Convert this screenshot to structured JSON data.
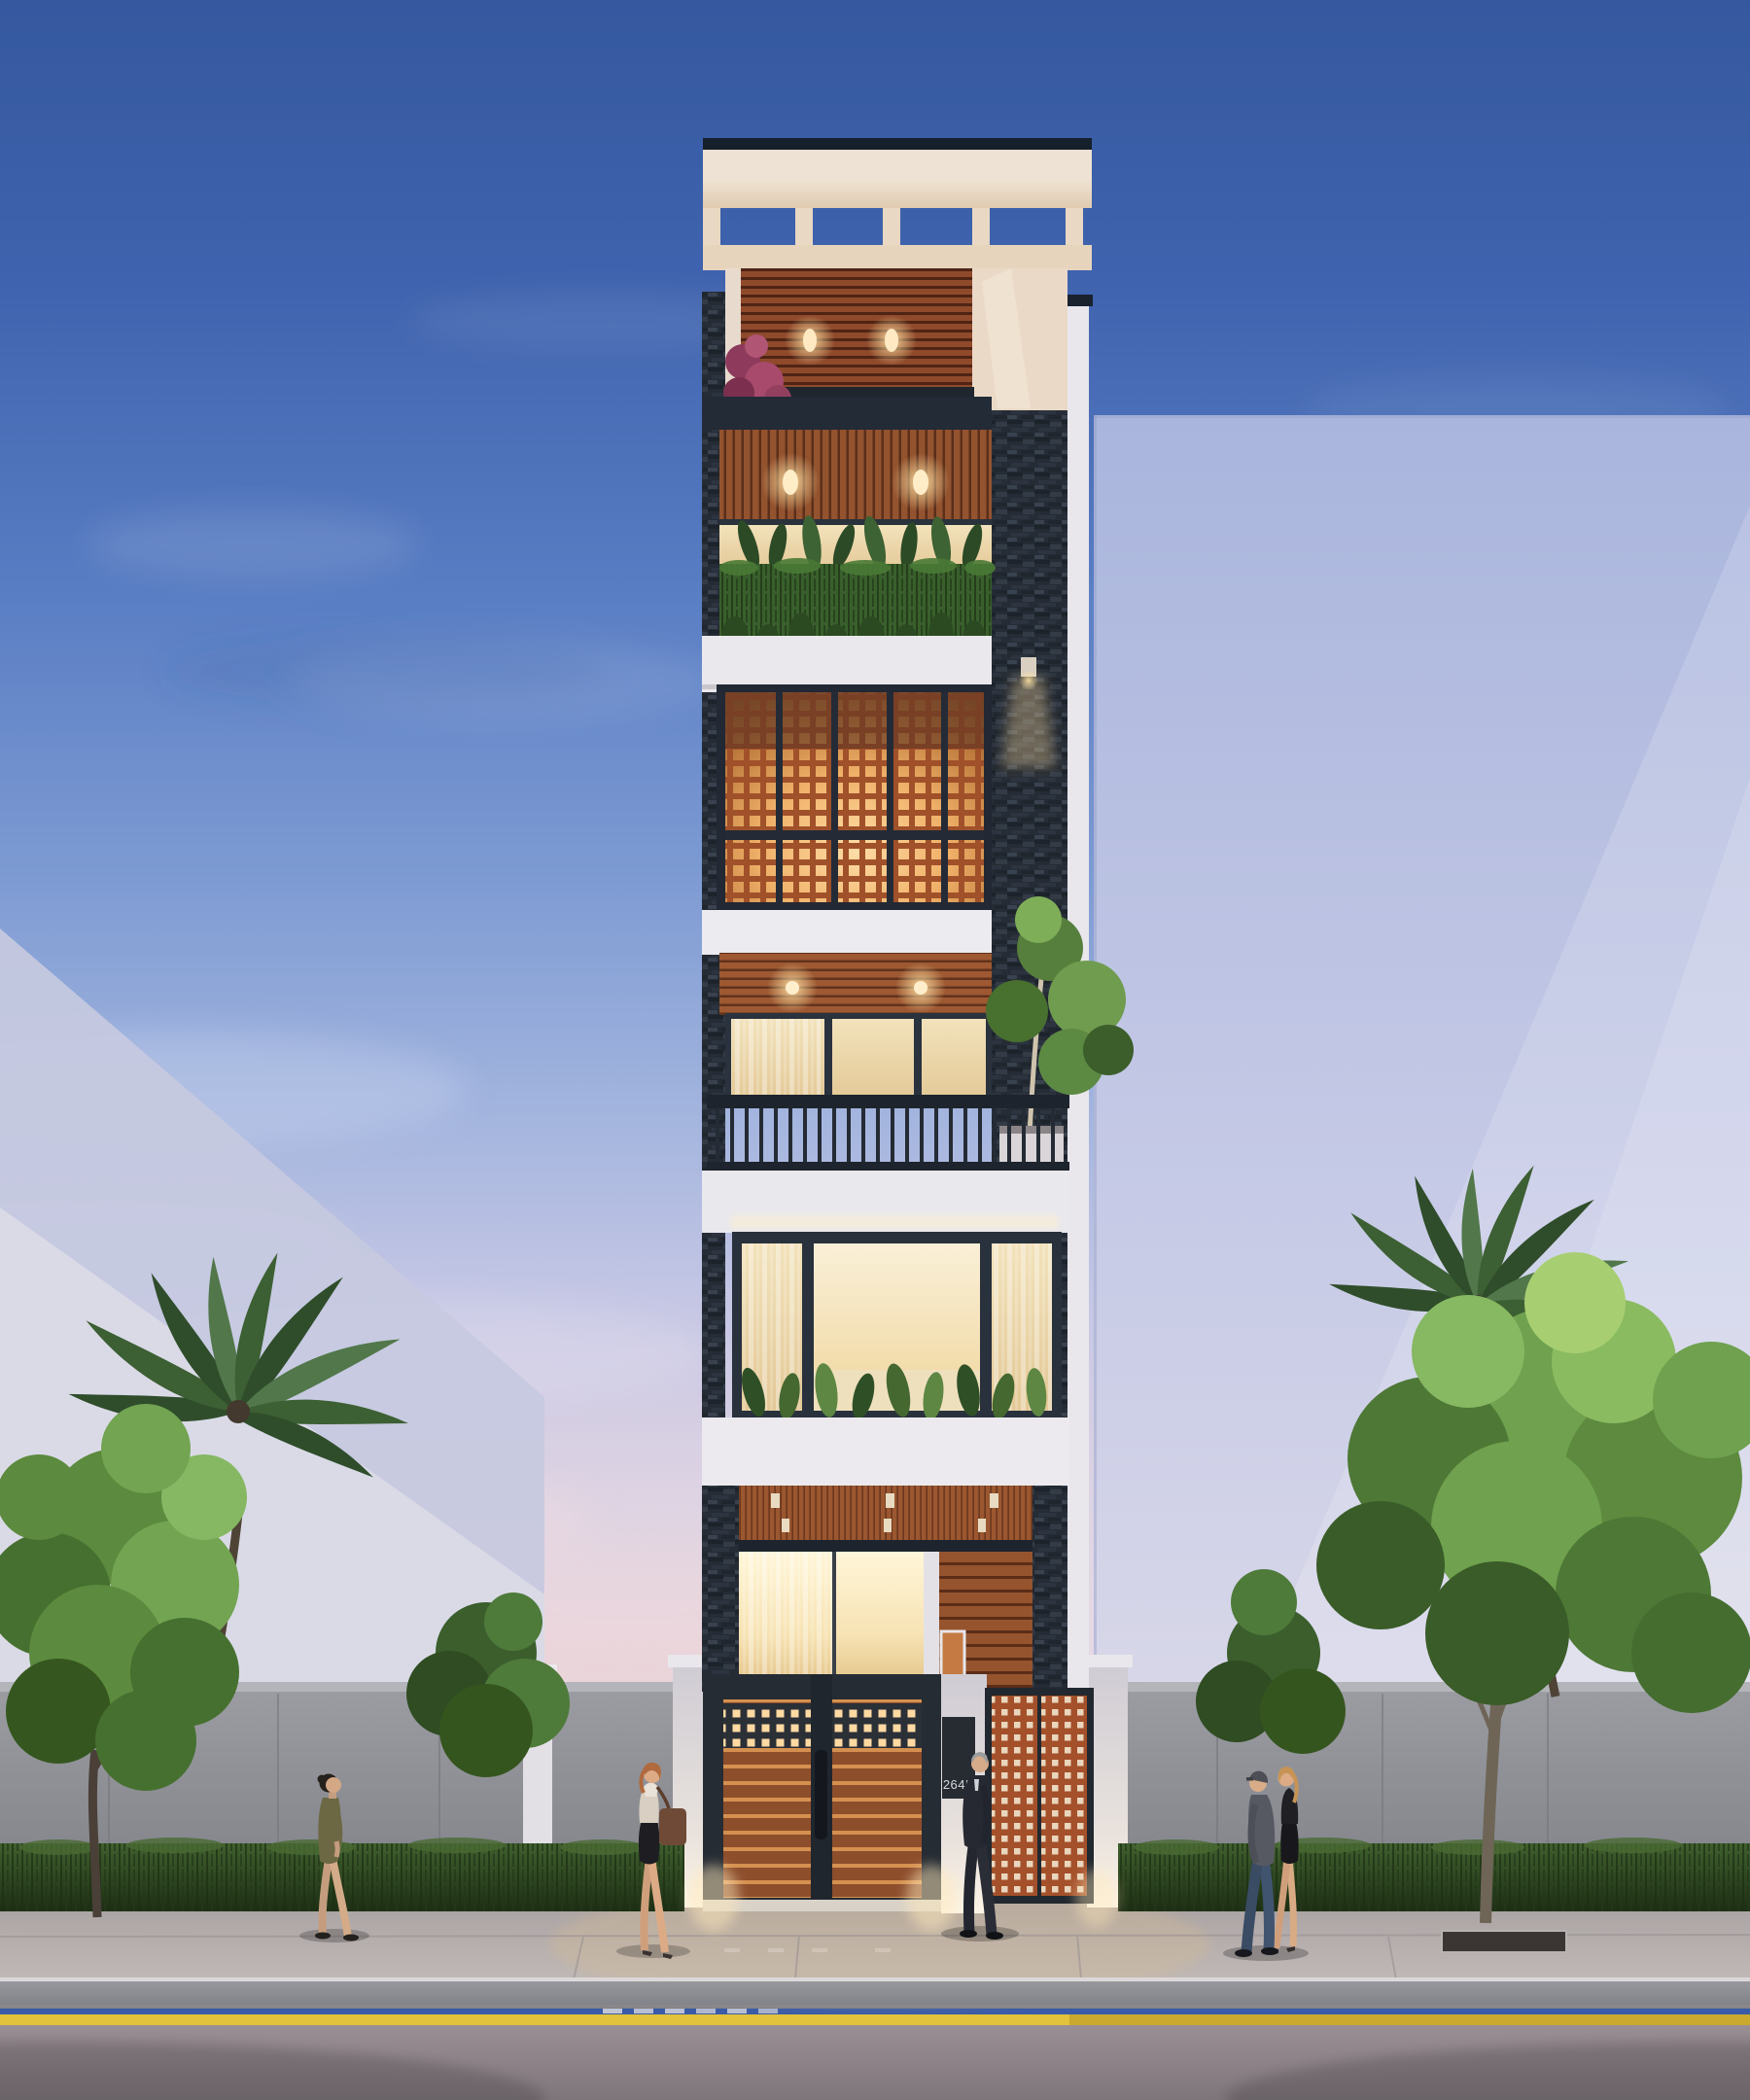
{
  "scene": {
    "kind": "architectural-exterior-rendering",
    "time_of_day": "dusk",
    "subject": "narrow six-storey modern tube house with rooftop pergola, timber slat ceilings, perforated corten screens, glowing interiors, street wall, palms and pedestrians"
  },
  "address_plate": {
    "text": "264K"
  },
  "palette": {
    "sky_top": "#3a5ca8",
    "sky_mid": "#7e9bd3",
    "sky_horizon_pink": "#e2d4e0",
    "glass_tower": "#c3c8e5",
    "bg_building": "#d9d8e6",
    "roof_cap": "#1c2430",
    "cream_fascia": "#ecdfd2",
    "stone_cladding": "#262c35",
    "timber_slat": "#b4663a",
    "lattice_glow": "#ffd9a2",
    "lattice_bar": "#a0512a",
    "warm_window": "#f5e6c3",
    "white_slab": "#eceaef",
    "foliage_green": "#5c8a3e",
    "hedge_green": "#2e4a20",
    "concrete_fence": "#8f9096",
    "sidewalk": "#b5aeae",
    "curb": "#c9c5c9",
    "lane_line_yellow": "#e0bd3a",
    "road": "#8d8388",
    "gate_frame": "#262c34",
    "gate_wood": "#8d4e2c"
  }
}
